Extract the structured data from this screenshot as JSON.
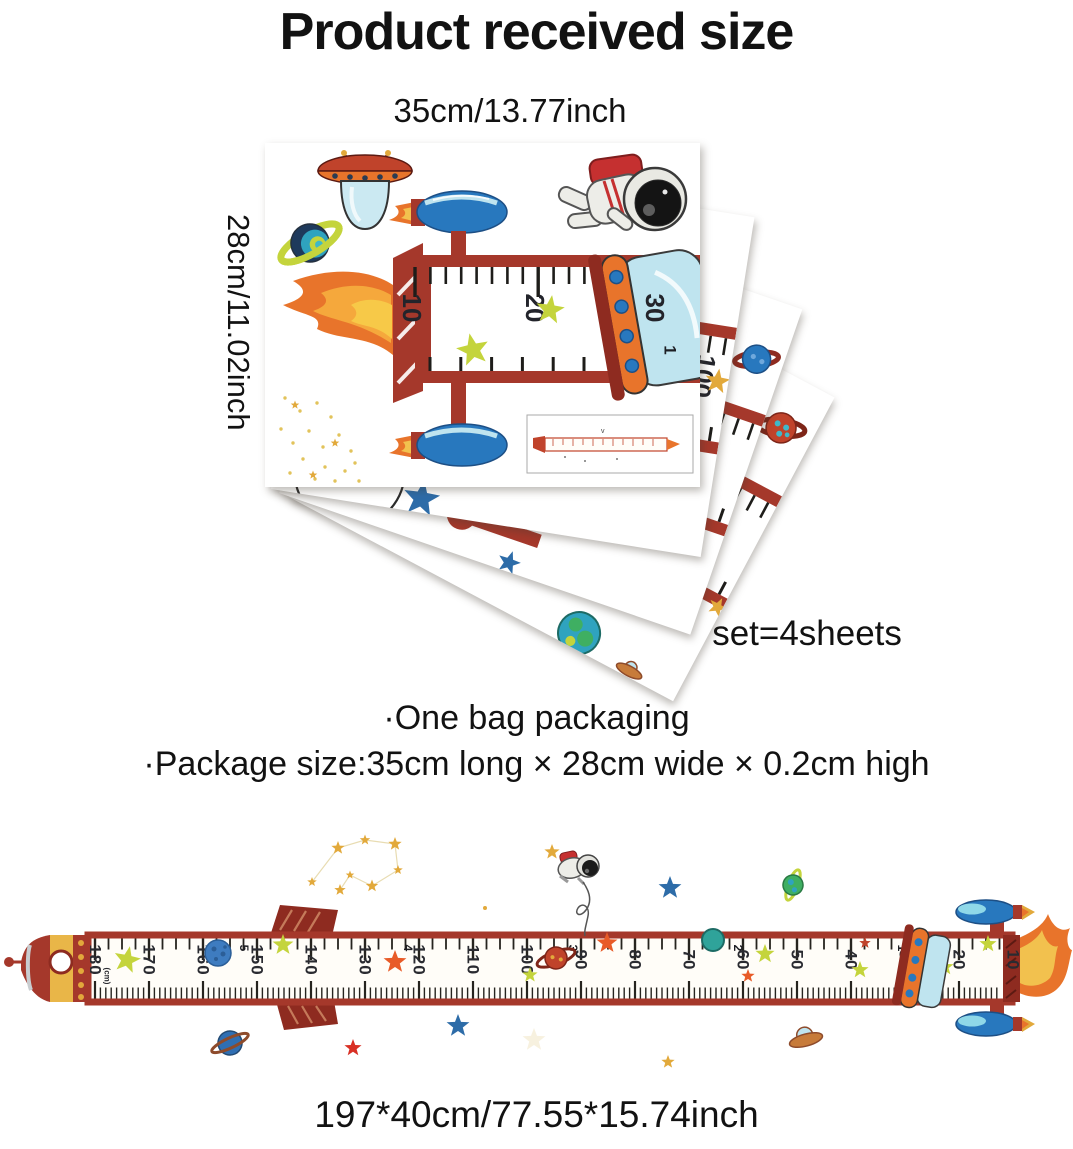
{
  "header": {
    "title": "Product received size"
  },
  "received_size": {
    "width_label": "35cm/13.77inch",
    "height_label": "28cm/11.02inch",
    "set_label": "1 set=4sheets",
    "sheet_ruler_numbers": [
      "10",
      "20",
      "30"
    ],
    "sheet_feet_number": "1",
    "back_sheet_number": "100"
  },
  "packaging": {
    "line1": "·One bag packaging",
    "line2": "·Package size:35cm long × 28cm wide × 0.2cm high"
  },
  "assembled_chart": {
    "size_label": "197*40cm/77.55*15.74inch",
    "unit_label": "(cm)",
    "cm_numbers": [
      "180",
      "170",
      "160",
      "150",
      "140",
      "130",
      "120",
      "110",
      "100",
      "90",
      "80",
      "70",
      "60",
      "50",
      "40",
      "30",
      "20",
      "10"
    ],
    "feet_numbers": [
      "6",
      "5",
      "4",
      "3",
      "2",
      "1"
    ]
  },
  "palette": {
    "ruler_red": "#A5382B",
    "dark_red": "#8E2B20",
    "flame_orange": "#E8742B",
    "flame_yellow": "#F2C14E",
    "booster_blue": "#2878BE",
    "light_blue": "#BFE4EF",
    "star_green": "#C4D43C",
    "star_gold": "#E2A93B",
    "star_blue": "#2D6CA8",
    "star_orange": "#E85B28",
    "planet_teal": "#2FA3BF",
    "text_black": "#121212"
  }
}
